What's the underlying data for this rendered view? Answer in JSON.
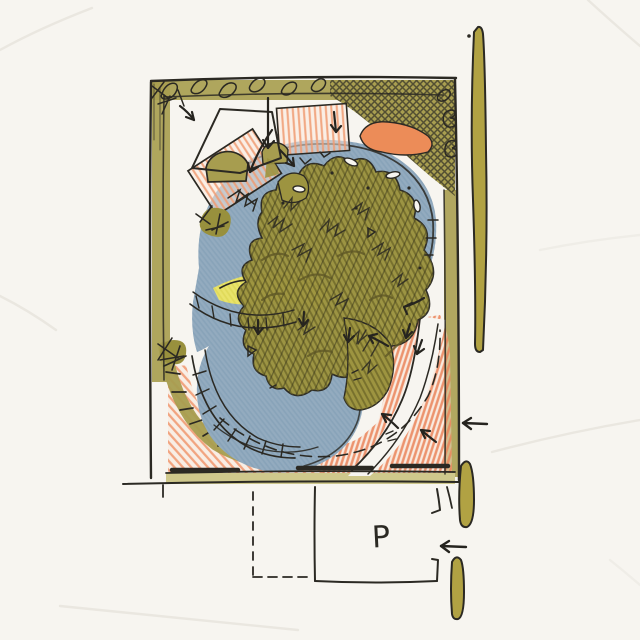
{
  "labels": {
    "parking": "P"
  },
  "icons": {
    "entry_arrow_left": "←",
    "flow_arrow_down": "↓",
    "flow_arrow_up_left": "↖"
  },
  "palette": {
    "paper": "#f7f5f0",
    "ink": "#2b2923",
    "olive_wash": "#a89e50",
    "olive_marker": "#b1a243",
    "olive_dark": "#5f5826",
    "blue_pencil": "#93abbf",
    "orange_pencil": "#ef9166",
    "orange_solid": "#ec8c58",
    "yellow_pencil": "#e9e36b",
    "pale_band": "#cfc88c"
  }
}
